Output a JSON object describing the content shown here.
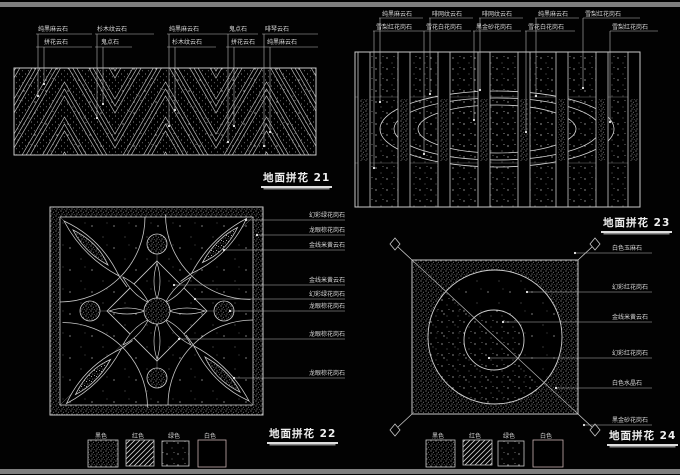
{
  "panel21": {
    "title": "地面拼花 21",
    "groups": [
      {
        "top": "纯黑麻云石",
        "bottom": "拼花云石"
      },
      {
        "top": "杉木纹云石",
        "bottom": "鬼点石"
      },
      {
        "top": "纯黑麻云石",
        "bottom": "杉木纹云石"
      },
      {
        "top": "鬼点石",
        "bottom": "拼花云石"
      },
      {
        "top": "啡琴云石",
        "bottom": "纯黑麻云石"
      }
    ]
  },
  "panel23": {
    "title": "地面拼花 23",
    "groups": [
      {
        "top": "纯黑麻云石",
        "bottom": "雪梨红花岗石"
      },
      {
        "top": "啡网纹云石",
        "bottom": "雪花白花岗石"
      },
      {
        "top": "啡网纹云石",
        "bottom": "黑金砂花岗石"
      },
      {
        "top": "纯黑麻云石",
        "bottom": "雪花白花岗石"
      },
      {
        "top": "雪梨红花岗石",
        "bottom": "雪梨红花岗石"
      }
    ]
  },
  "panel22": {
    "title": "地面拼花 22",
    "labels": [
      "幻彩绿花岗石",
      "龙眼棕花岗石",
      "金线米黄云石",
      "金线米黄云石",
      "幻彩绿花岗石",
      "龙眼棕花岗石",
      "龙眼棕花岗石",
      "龙眼棕花岗石"
    ]
  },
  "panel24": {
    "title": "地面拼花 24",
    "labels": [
      "白色玉麻石",
      "幻彩红花岗石",
      "金线米黄云石",
      "幻彩红花岗石",
      "白色水晶石",
      "黑金砂花岗石"
    ]
  },
  "legend": {
    "items": [
      {
        "label": "黑色",
        "pattern": "dense-speckle"
      },
      {
        "label": "红色",
        "pattern": "diagonal-hatch"
      },
      {
        "label": "绿色",
        "pattern": "sparse-speckle"
      },
      {
        "label": "白色",
        "pattern": "plain"
      }
    ]
  },
  "colors": {
    "background": "#000000",
    "line": "#c8c8c8",
    "frame_bar": "#7e7e7e",
    "text": "#d9d9d9"
  }
}
